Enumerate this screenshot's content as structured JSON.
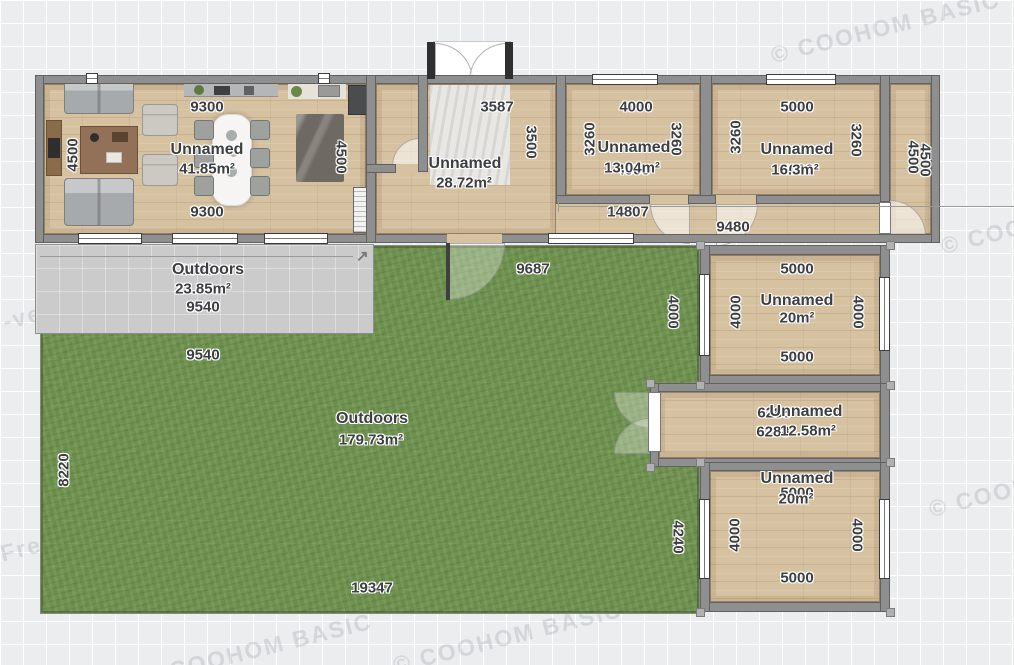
{
  "app": {
    "name": "floor-plan-canvas"
  },
  "watermark": {
    "text": "© COOHOM BASIC",
    "fragment_version": "-version",
    "fragment_free": "Free"
  },
  "icons": {
    "resize_arrow": "↗"
  },
  "palette": {
    "wall": "#8f8f8f",
    "wood": "#d6c1a1",
    "grass": "#6f924f",
    "patio": "#cbcbcb",
    "label": "#3c3e42",
    "window": "#ffffff"
  },
  "rooms": {
    "living": {
      "name": "Unnamed",
      "area": "41.85m²",
      "dim_top": "9300",
      "dim_bottom": "9300",
      "dim_left": "4500",
      "dim_right": "4500"
    },
    "entry": {
      "name": "Unnamed",
      "area": "28.72m²",
      "dim_top": "3587",
      "dim_right": "3500"
    },
    "bedroom_a": {
      "name": "Unnamed",
      "area": "13.04m²",
      "dim_top": "4000",
      "dim_bottom": "4000",
      "dim_left": "3260",
      "dim_right": "3260"
    },
    "bedroom_b": {
      "name": "Unnamed",
      "area": "16.3m²",
      "dim_top": "5000",
      "dim_bottom": "5000",
      "dim_left": "3260",
      "dim_right": "3260"
    },
    "side_corridor": {
      "dim_a": "4500",
      "dim_b": "4500"
    },
    "hall_top": {
      "dim_length": "14807",
      "dim_partial": "9480"
    },
    "room_mid": {
      "name": "Unnamed",
      "area": "20m²",
      "dim_top": "5000",
      "dim_bottom": "5000",
      "dim_left": "4000",
      "dim_right": "4000",
      "dim_outer_left": "4000"
    },
    "hall_right": {
      "name": "Unnamed",
      "area": "12.58m²",
      "dim_top": "6288",
      "dim_bottom": "6288"
    },
    "room_bottom": {
      "name": "Unnamed",
      "area": "20m²",
      "dim_top": "5000",
      "dim_bottom": "5000",
      "dim_left": "4000",
      "dim_right": "4000"
    },
    "patio": {
      "name": "Outdoors",
      "area": "23.85m²",
      "dim_top": "9540",
      "dim_bottom": "9540"
    },
    "garden": {
      "name": "Outdoors",
      "area": "179.73m²",
      "dim_top": "9687",
      "dim_upper": "9540",
      "dim_left": "8220",
      "dim_right": "4240",
      "dim_bottom": "19347"
    }
  }
}
